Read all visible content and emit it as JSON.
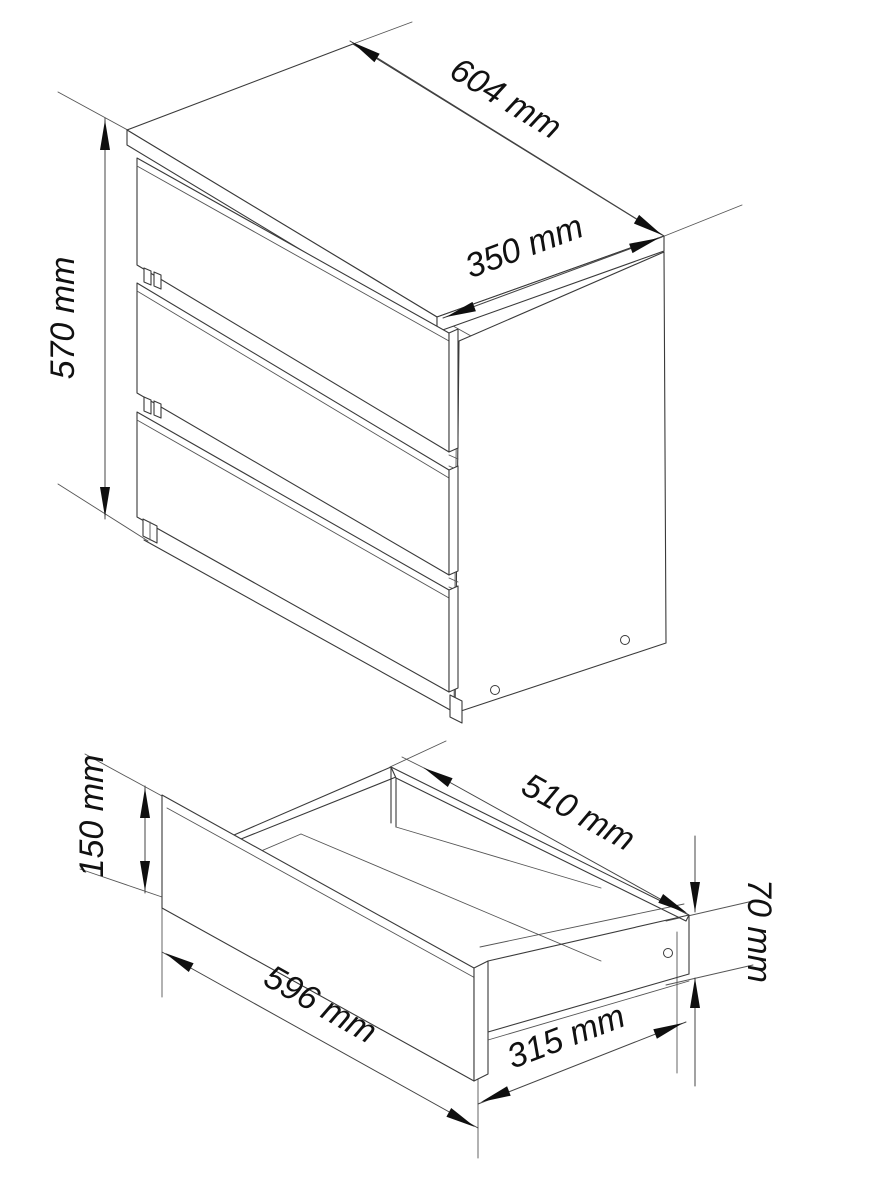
{
  "figure": {
    "type": "furniture-dimension-drawing",
    "subject": "three-drawer chest with open drawer detail"
  },
  "cabinet": {
    "dims": {
      "width": {
        "label": "604 mm"
      },
      "depth": {
        "label": "350 mm"
      },
      "height": {
        "label": "570 mm"
      }
    }
  },
  "drawer": {
    "dims": {
      "inner_height": {
        "label": "150 mm"
      },
      "depth": {
        "label": "510 mm"
      },
      "width": {
        "label": "596 mm"
      },
      "inner_depth": {
        "label": "315 mm"
      },
      "side_height": {
        "label": "70 mm"
      }
    }
  },
  "colors": {
    "line": "#3a3a3a",
    "arrow": "#0f0f0f",
    "text": "#111111",
    "background": "#ffffff"
  }
}
